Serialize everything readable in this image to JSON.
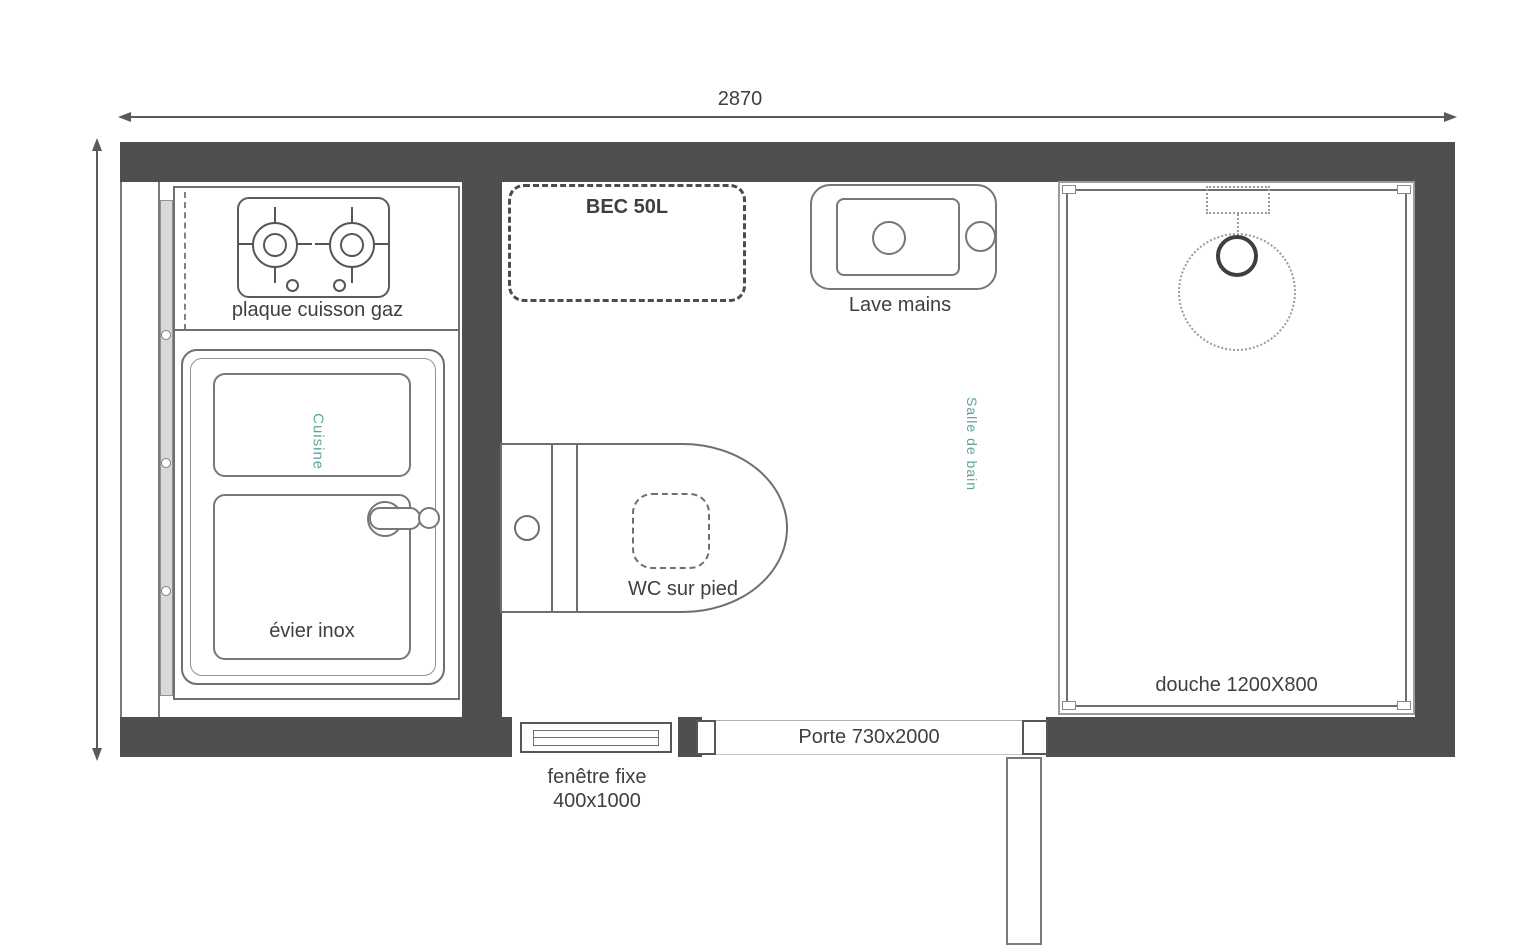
{
  "dimensions": {
    "overall_width": "2870"
  },
  "labels": {
    "stove": "plaque cuisson gaz",
    "sink": "évier inox",
    "kitchen": "Cuisine",
    "bathroom": "Salle de bain",
    "water_heater": "BEC 50L",
    "hand_basin": "Lave mains",
    "toilet": "WC sur pied",
    "shower": "douche 1200X800",
    "window_line1": "fenêtre fixe",
    "window_line2": "400x1000",
    "door": "Porte 730x2000"
  },
  "colors": {
    "wall": "#4f4f4f",
    "line": "#6f6f6f",
    "accent_teal": "#5ba39b",
    "text": "#3f3f3f",
    "background": "#ffffff"
  }
}
